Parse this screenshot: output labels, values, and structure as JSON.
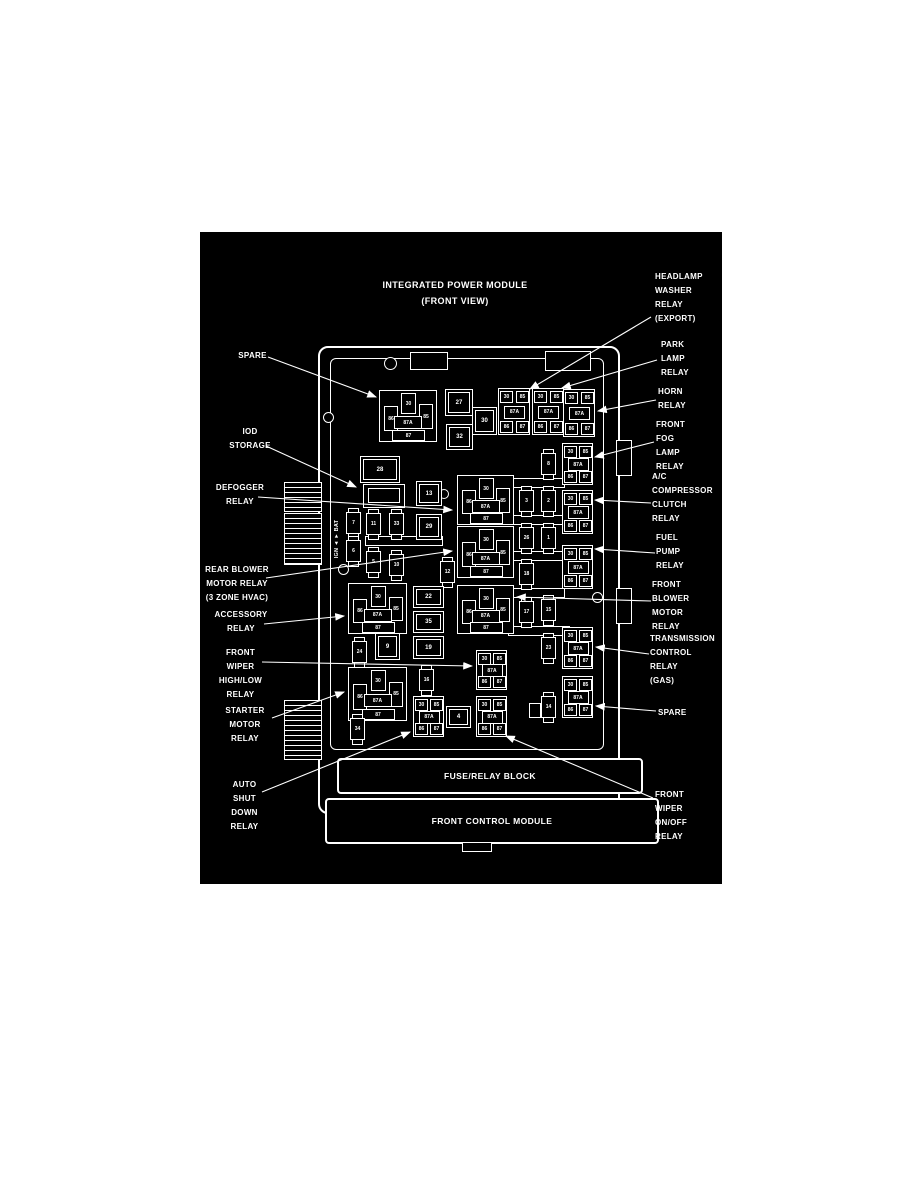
{
  "title": {
    "line1": "INTEGRATED POWER MODULE",
    "line2": "(FRONT VIEW)"
  },
  "colors": {
    "page_bg": "#ffffff",
    "panel_bg": "#000000",
    "line": "#ffffff"
  },
  "labels": {
    "left": [
      {
        "id": "spare-left",
        "lines": [
          "SPARE"
        ]
      },
      {
        "id": "iod-storage",
        "lines": [
          "IOD",
          "STORAGE"
        ]
      },
      {
        "id": "defogger-relay",
        "lines": [
          "DEFOGGER",
          "RELAY"
        ]
      },
      {
        "id": "rear-blower-motor-relay",
        "lines": [
          "REAR BLOWER",
          "MOTOR RELAY",
          "(3 ZONE HVAC)"
        ]
      },
      {
        "id": "accessory-relay",
        "lines": [
          "ACCESSORY",
          "RELAY"
        ]
      },
      {
        "id": "front-wiper-high-low-relay",
        "lines": [
          "FRONT",
          "WIPER",
          "HIGH/LOW",
          "RELAY"
        ]
      },
      {
        "id": "starter-motor-relay",
        "lines": [
          "STARTER",
          "MOTOR",
          "RELAY"
        ]
      },
      {
        "id": "auto-shut-down-relay",
        "lines": [
          "AUTO",
          "SHUT",
          "DOWN",
          "RELAY"
        ]
      }
    ],
    "right": [
      {
        "id": "headlamp-washer-relay",
        "lines": [
          "HEADLAMP",
          "WASHER",
          "RELAY",
          "(EXPORT)"
        ]
      },
      {
        "id": "park-lamp-relay",
        "lines": [
          "PARK",
          "LAMP",
          "RELAY"
        ]
      },
      {
        "id": "horn-relay",
        "lines": [
          "HORN",
          "RELAY"
        ]
      },
      {
        "id": "front-fog-lamp-relay",
        "lines": [
          "FRONT",
          "FOG",
          "LAMP",
          "RELAY"
        ]
      },
      {
        "id": "ac-compressor-clutch-relay",
        "lines": [
          "A/C",
          "COMPRESSOR",
          "CLUTCH",
          "RELAY"
        ]
      },
      {
        "id": "fuel-pump-relay",
        "lines": [
          "FUEL",
          "PUMP",
          "RELAY"
        ]
      },
      {
        "id": "front-blower-motor-relay",
        "lines": [
          "FRONT",
          "BLOWER",
          "MOTOR",
          "RELAY"
        ]
      },
      {
        "id": "transmission-control-relay",
        "lines": [
          "TRANSMISSION",
          "CONTROL",
          "RELAY",
          "(GAS)"
        ]
      },
      {
        "id": "spare-right",
        "lines": [
          "SPARE"
        ]
      },
      {
        "id": "front-wiper-on-off-relay",
        "lines": [
          "FRONT",
          "WIPER",
          "ON/OFF",
          "RELAY"
        ]
      }
    ]
  },
  "module": {
    "side_text": "IGN ◄  ► BAT",
    "fuse_relay_block_label": "FUSE/RELAY BLOCK",
    "front_control_module_label": "FRONT CONTROL MODULE",
    "standard_pin_labels": {
      "top": "30",
      "left": "86",
      "center": "87A",
      "right": "85",
      "bottom": "87"
    },
    "micro_pin_labels": {
      "tl": "30",
      "tr": "85",
      "center": "87A",
      "bl": "86",
      "br": "87"
    },
    "standard_relays": [
      {
        "id": "relay-spare-top-left"
      },
      {
        "id": "relay-defogger"
      },
      {
        "id": "relay-rear-blower"
      },
      {
        "id": "relay-front-blower"
      },
      {
        "id": "relay-accessory"
      },
      {
        "id": "relay-starter"
      }
    ],
    "micro_relays": [
      {
        "id": "relay-headlamp-washer"
      },
      {
        "id": "relay-park-lamp"
      },
      {
        "id": "relay-horn"
      },
      {
        "id": "relay-front-fog"
      },
      {
        "id": "relay-ac-compressor"
      },
      {
        "id": "relay-fuel-pump"
      },
      {
        "id": "relay-transmission"
      },
      {
        "id": "relay-spare-right"
      },
      {
        "id": "relay-wiper-high-low"
      },
      {
        "id": "relay-auto-shut-down"
      },
      {
        "id": "relay-wiper-on-off"
      }
    ],
    "fuses": [
      {
        "id": "fuse-7",
        "label": "7"
      },
      {
        "id": "fuse-6",
        "label": "6"
      },
      {
        "id": "fuse-11",
        "label": "11"
      },
      {
        "id": "fuse-33",
        "label": "33"
      },
      {
        "id": "fuse-5",
        "label": "5"
      },
      {
        "id": "fuse-10",
        "label": "10"
      },
      {
        "id": "fuse-24",
        "label": "24"
      },
      {
        "id": "fuse-12",
        "label": "12"
      },
      {
        "id": "fuse-16",
        "label": "16"
      },
      {
        "id": "fuse-34",
        "label": "34"
      },
      {
        "id": "fuse-8",
        "label": "8"
      },
      {
        "id": "fuse-3",
        "label": "3"
      },
      {
        "id": "fuse-2",
        "label": "2"
      },
      {
        "id": "fuse-26",
        "label": "26"
      },
      {
        "id": "fuse-1",
        "label": "1"
      },
      {
        "id": "fuse-18",
        "label": "18"
      },
      {
        "id": "fuse-17",
        "label": "17"
      },
      {
        "id": "fuse-15",
        "label": "15"
      },
      {
        "id": "fuse-23",
        "label": "23"
      },
      {
        "id": "fuse-14",
        "label": "14"
      }
    ],
    "boxes": [
      {
        "id": "box-28",
        "label": "28"
      },
      {
        "id": "box-27",
        "label": "27"
      },
      {
        "id": "box-32",
        "label": "32"
      },
      {
        "id": "box-30",
        "label": "30"
      },
      {
        "id": "box-13",
        "label": "13"
      },
      {
        "id": "box-29",
        "label": "29"
      },
      {
        "id": "box-22",
        "label": "22"
      },
      {
        "id": "box-35",
        "label": "35"
      },
      {
        "id": "box-19",
        "label": "19"
      },
      {
        "id": "box-9",
        "label": "9"
      },
      {
        "id": "box-4",
        "label": "4"
      }
    ]
  }
}
